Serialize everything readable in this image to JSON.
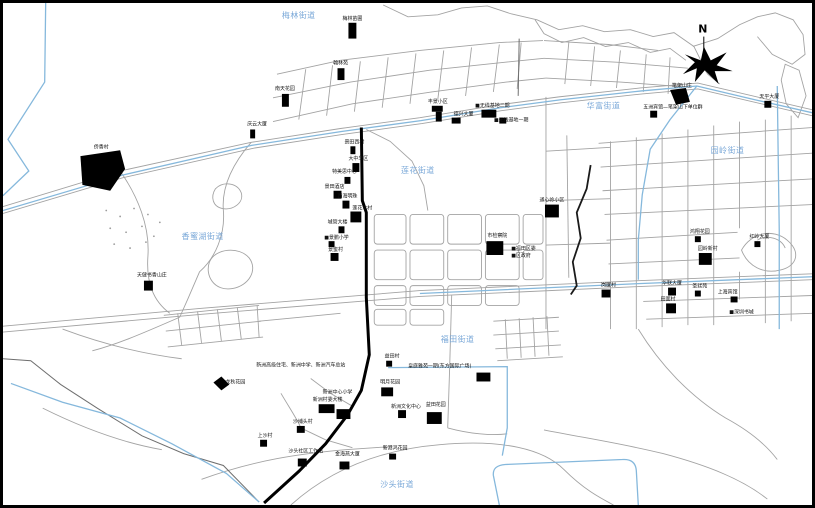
{
  "colors": {
    "road_gray": "#a3a3a3",
    "road_dark": "#6e6e6e",
    "water_blue": "#85b8dc",
    "building_black": "#000000",
    "label_black": "#111111",
    "district_blue": "#7aa8d8",
    "boundary_black": "#2a2a2a"
  },
  "map": {
    "north_label": "N",
    "districts": [
      {
        "t": "梅林街道",
        "x": 281,
        "y": 15
      },
      {
        "t": "华富街道",
        "x": 588,
        "y": 107
      },
      {
        "t": "园岭街道",
        "x": 713,
        "y": 152
      },
      {
        "t": "莲花街道",
        "x": 401,
        "y": 172
      },
      {
        "t": "香蜜湖街道",
        "x": 180,
        "y": 239
      },
      {
        "t": "福田街道",
        "x": 441,
        "y": 343
      },
      {
        "t": "沙头街道",
        "x": 380,
        "y": 490
      }
    ],
    "landmarks": [
      {
        "t": "梅林苗圃",
        "x": 352,
        "y": 17,
        "b": [
          [
            348,
            20,
            8,
            16
          ]
        ]
      },
      {
        "t": "侨香村",
        "x": 99,
        "y": 147,
        "poly": "78,155 118,149 123,168 108,190 80,184"
      },
      {
        "t": "翰林苑",
        "x": 340,
        "y": 62,
        "b": [
          [
            337,
            66,
            7,
            12
          ]
        ]
      },
      {
        "t": "南天花园",
        "x": 284,
        "y": 88,
        "b": [
          [
            281,
            92,
            7,
            13
          ]
        ]
      },
      {
        "t": "庆云大厦",
        "x": 256,
        "y": 124,
        "b": [
          [
            249,
            128,
            5,
            9
          ]
        ]
      },
      {
        "t": "笔架山庄",
        "x": 684,
        "y": 85,
        "poly": "672,88 688,86 692,100 678,103"
      },
      {
        "t": "五洲宾馆—笔架山下单位群",
        "x": 645,
        "y": 107,
        "anchor": "start",
        "b": [
          [
            652,
            109,
            7,
            7
          ]
        ]
      },
      {
        "t": "天平大厦",
        "x": 772,
        "y": 96,
        "b": [
          [
            767,
            99,
            7,
            7
          ]
        ]
      },
      {
        "t": "丰景小区",
        "x": 438,
        "y": 101,
        "b": [
          [
            432,
            104,
            11,
            6
          ],
          [
            436,
            110,
            6,
            10
          ]
        ]
      },
      {
        "t": "德兴大厦",
        "x": 464,
        "y": 114,
        "b": [
          [
            452,
            116,
            9,
            6
          ]
        ]
      },
      {
        "t": "■无线基地二期",
        "x": 493,
        "y": 105,
        "b": [
          [
            482,
            108,
            15,
            8
          ]
        ]
      },
      {
        "t": "■无线基地一期",
        "x": 512,
        "y": 120,
        "b": [
          [
            500,
            116,
            7,
            6
          ]
        ]
      },
      {
        "t": "景田西村",
        "x": 354,
        "y": 142,
        "b": [
          [
            350,
            145,
            5,
            8
          ]
        ]
      },
      {
        "t": "大中华区",
        "x": 358,
        "y": 159,
        "b": [
          [
            352,
            162,
            7,
            9
          ]
        ]
      },
      {
        "t": "特美思中心",
        "x": 344,
        "y": 172,
        "b": [
          [
            344,
            176,
            6,
            7
          ]
        ]
      },
      {
        "t": "景田酒店",
        "x": 334,
        "y": 187,
        "b": [
          [
            333,
            190,
            8,
            8
          ]
        ]
      },
      {
        "t": "西海明珠",
        "x": 347,
        "y": 197,
        "b": [
          [
            342,
            200,
            7,
            8
          ]
        ]
      },
      {
        "t": "莲花北村",
        "x": 362,
        "y": 209,
        "b": [
          [
            350,
            211,
            11,
            11
          ]
        ]
      },
      {
        "t": "城管大楼",
        "x": 337,
        "y": 223,
        "b": [
          [
            338,
            226,
            6,
            7
          ]
        ]
      },
      {
        "t": "■景鹏小学",
        "x": 336,
        "y": 239,
        "b": [
          [
            328,
            241,
            6,
            6
          ]
        ]
      },
      {
        "t": "景蜜村",
        "x": 335,
        "y": 251,
        "b": [
          [
            330,
            253,
            8,
            8
          ]
        ]
      },
      {
        "t": "通心岭小区",
        "x": 553,
        "y": 201,
        "b": [
          [
            546,
            204,
            14,
            13
          ]
        ]
      },
      {
        "t": "市检察院",
        "x": 498,
        "y": 237,
        "b": [
          [
            487,
            241,
            17,
            14
          ]
        ]
      },
      {
        "t": "■福田区委",
        "x": 512,
        "y": 250,
        "anchor": "start"
      },
      {
        "t": "■区政府",
        "x": 512,
        "y": 257,
        "anchor": "start"
      },
      {
        "t": "天健书香山庄",
        "x": 150,
        "y": 277,
        "b": [
          [
            142,
            281,
            9,
            10
          ]
        ]
      },
      {
        "t": "鸿翔花园",
        "x": 702,
        "y": 233,
        "b": [
          [
            697,
            236,
            6,
            6
          ]
        ]
      },
      {
        "t": "园岭新村",
        "x": 710,
        "y": 250,
        "b": [
          [
            701,
            253,
            13,
            12
          ]
        ]
      },
      {
        "t": "红岭大厦",
        "x": 762,
        "y": 238,
        "b": [
          [
            757,
            241,
            6,
            6
          ]
        ]
      },
      {
        "t": "岗厦村",
        "x": 610,
        "y": 287,
        "b": [
          [
            603,
            290,
            9,
            8
          ]
        ]
      },
      {
        "t": "华联大厦",
        "x": 674,
        "y": 285,
        "b": [
          [
            670,
            288,
            8,
            8
          ]
        ]
      },
      {
        "t": "圣廷苑",
        "x": 702,
        "y": 288,
        "b": [
          [
            697,
            291,
            6,
            6
          ]
        ]
      },
      {
        "t": "上海宾馆",
        "x": 730,
        "y": 294,
        "b": [
          [
            733,
            297,
            7,
            6
          ]
        ]
      },
      {
        "t": "田面村",
        "x": 670,
        "y": 301,
        "b": [
          [
            668,
            304,
            10,
            10
          ]
        ]
      },
      {
        "t": "■深圳书城",
        "x": 744,
        "y": 314
      },
      {
        "t": "新洲高级住宅、新洲中学、新洲汽车总站",
        "x": 300,
        "y": 368
      },
      {
        "t": "益田村",
        "x": 392,
        "y": 359,
        "b": [
          [
            386,
            362,
            6,
            6
          ]
        ]
      },
      {
        "t": "皇庭雅苑一期(东方国际广场)",
        "x": 440,
        "y": 369,
        "b": [
          [
            477,
            374,
            14,
            9
          ]
        ]
      },
      {
        "t": "明月花园",
        "x": 390,
        "y": 385,
        "b": [
          [
            381,
            389,
            12,
            9
          ]
        ]
      },
      {
        "t": "新洲中心小学",
        "x": 337,
        "y": 395
      },
      {
        "t": "新洲村委大楼",
        "x": 327,
        "y": 403,
        "b": [
          [
            318,
            406,
            16,
            9
          ],
          [
            336,
            411,
            14,
            10
          ]
        ]
      },
      {
        "t": "新洲文化中心",
        "x": 406,
        "y": 410,
        "b": [
          [
            398,
            412,
            8,
            8
          ]
        ]
      },
      {
        "t": "益田花园",
        "x": 436,
        "y": 408,
        "b": [
          [
            427,
            414,
            15,
            12
          ]
        ]
      },
      {
        "t": "龙秋花园",
        "x": 234,
        "y": 385,
        "poly": "212,384 220,378 228,386 220,392"
      },
      {
        "t": "沙埔头村",
        "x": 302,
        "y": 425,
        "b": [
          [
            296,
            428,
            8,
            7
          ]
        ]
      },
      {
        "t": "上沙村",
        "x": 264,
        "y": 439,
        "b": [
          [
            259,
            442,
            7,
            7
          ]
        ]
      },
      {
        "t": "沙头社区工作站",
        "x": 305,
        "y": 455,
        "b": [
          [
            297,
            461,
            9,
            8
          ]
        ]
      },
      {
        "t": "金海燕大厦",
        "x": 347,
        "y": 458,
        "b": [
          [
            339,
            464,
            10,
            8
          ]
        ]
      },
      {
        "t": "新港鸿花园",
        "x": 395,
        "y": 452,
        "b": [
          [
            389,
            456,
            7,
            6
          ]
        ]
      }
    ]
  }
}
